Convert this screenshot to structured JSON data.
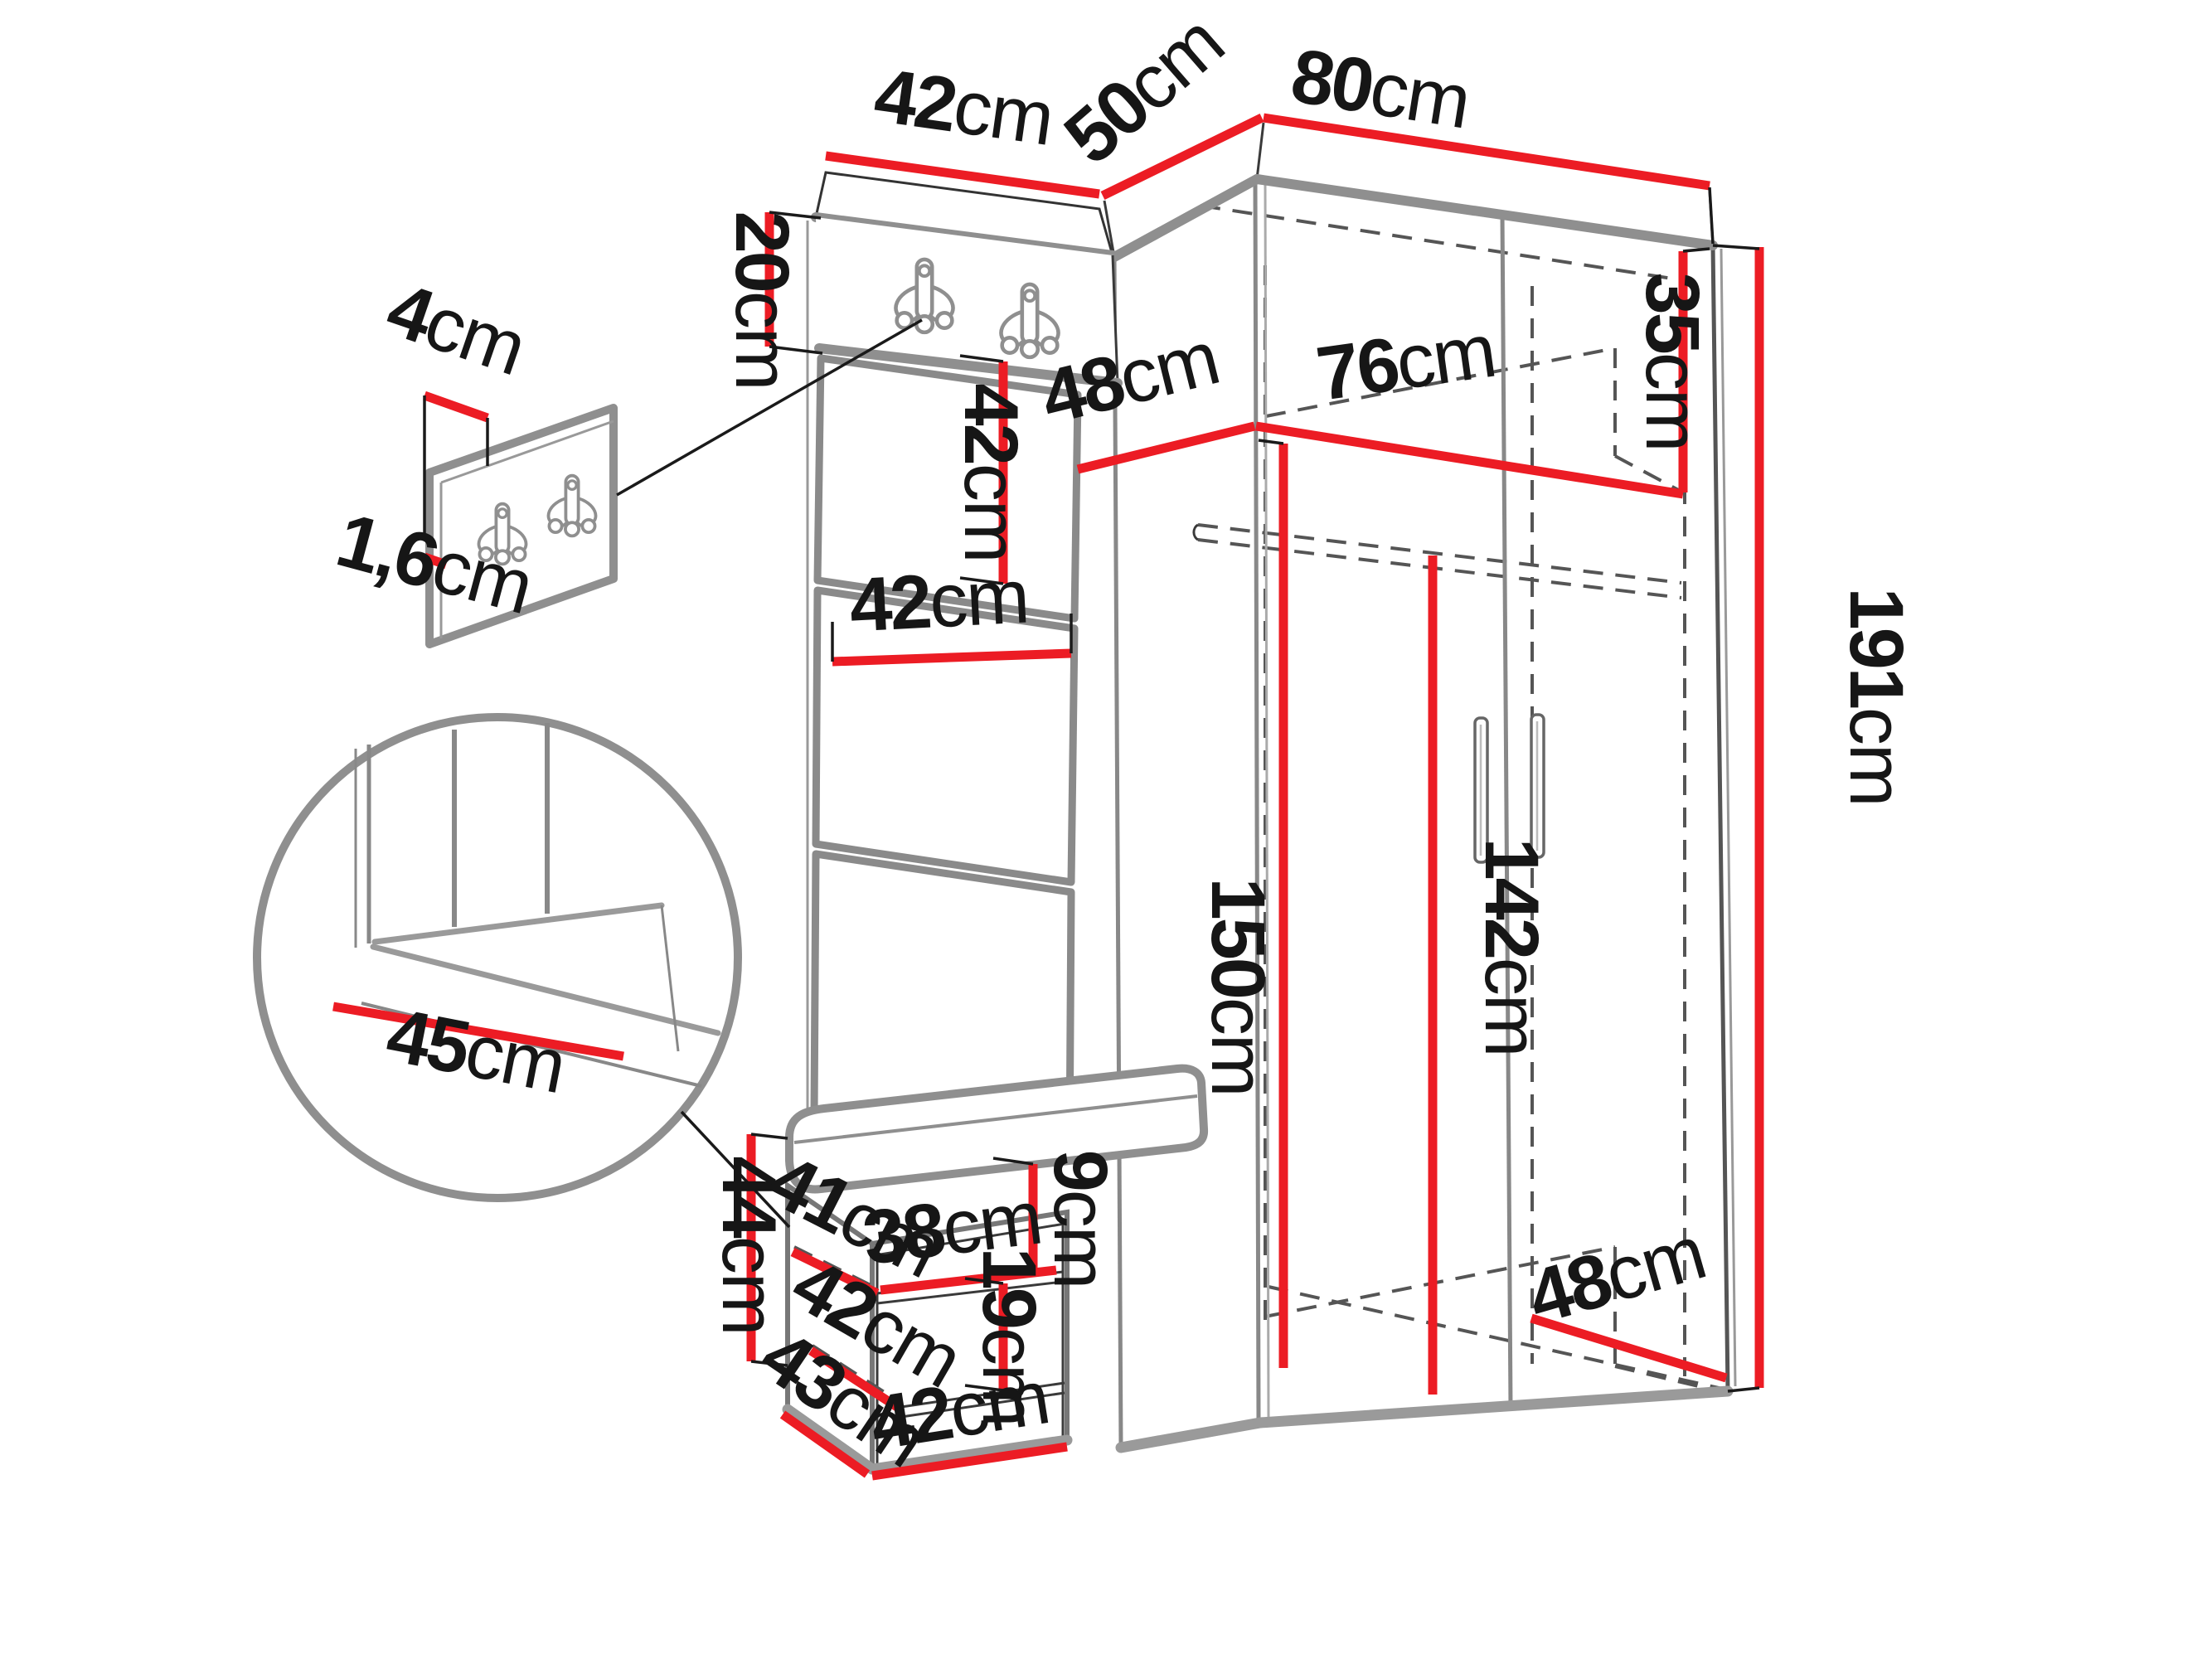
{
  "diagram": {
    "title": "hallway wardrobe set dimension drawing",
    "unit": "cm",
    "colors": {
      "dimension_red": "#ec1c24",
      "edge_gray": "#8f8f8f",
      "line_black": "#1a1a1a",
      "dash_gray": "#555555"
    },
    "dimensions": {
      "panel_top_width": {
        "num": "42",
        "unit": "cm"
      },
      "corner_top_width": {
        "num": "50",
        "unit": "cm"
      },
      "wardrobe_top_width": {
        "num": "80",
        "unit": "cm"
      },
      "hook_panel_height": {
        "num": "20",
        "unit": "cm"
      },
      "wall_panel_depth": {
        "num": "4",
        "unit": "cm"
      },
      "wall_panel_thickness": {
        "num": "1,6",
        "unit": "cm"
      },
      "padded_square_height": {
        "num": "42",
        "unit": "cm"
      },
      "padded_square_width": {
        "num": "42",
        "unit": "cm"
      },
      "interior_shelf_depth": {
        "num": "48",
        "unit": "cm"
      },
      "interior_width": {
        "num": "76",
        "unit": "cm"
      },
      "top_shelf_height": {
        "num": "35",
        "unit": "cm"
      },
      "wardrobe_height": {
        "num": "191",
        "unit": "cm"
      },
      "left_interior_height": {
        "num": "150",
        "unit": "cm"
      },
      "door_interior_height": {
        "num": "142",
        "unit": "cm"
      },
      "seat_depth_detail": {
        "num": "45",
        "unit": "cm"
      },
      "bench_height": {
        "num": "44",
        "unit": "cm"
      },
      "bench_shelf_depth": {
        "num": "41",
        "unit": "cm"
      },
      "bench_shelf_width": {
        "num": "38",
        "unit": "cm"
      },
      "cushion_thickness": {
        "num": "9",
        "unit": "cm"
      },
      "lower_shelf_depth": {
        "num": "42",
        "unit": "cm"
      },
      "lower_compartment_height": {
        "num": "19",
        "unit": "cm"
      },
      "bench_depth": {
        "num": "43",
        "unit": "cm"
      },
      "bench_width": {
        "num": "42",
        "unit": "cm"
      },
      "interior_bottom_depth": {
        "num": "48",
        "unit": "cm"
      }
    }
  }
}
